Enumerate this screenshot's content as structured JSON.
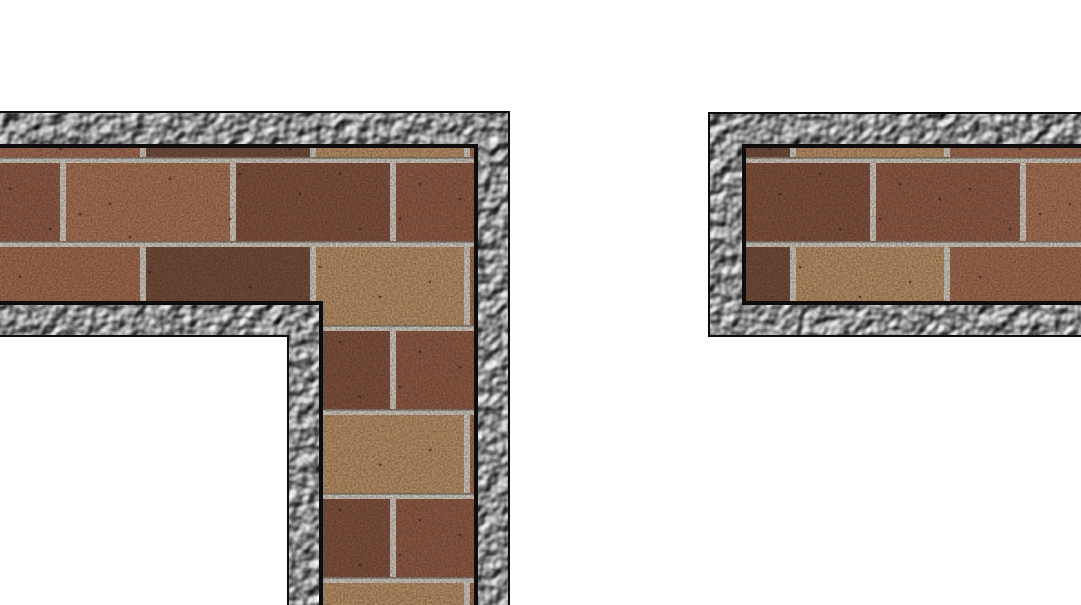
{
  "scene": {
    "description": "Top-down game map view: two brick wall segments with gravel stone borders on a white floor",
    "width": 1081,
    "height": 605,
    "background_color": "#ffffff"
  },
  "colors": {
    "outline": "#0c0c0c",
    "gravel_base": "#8f8f8f",
    "gravel_highlight": "#f0f0f0",
    "gravel_shadow": "#2f2f2f",
    "mortar": "#c9c4ba",
    "mortar_shadow": "#6b6258",
    "speckle": "#32211a",
    "brick_palette": [
      "#9a674c",
      "#6f4a39",
      "#b28b63",
      "#8a5843",
      "#a06e50",
      "#7c4f3b"
    ]
  },
  "walls": [
    {
      "name": "l-shaped-wall-segment",
      "outer": [
        [
          -6,
          111
        ],
        [
          510,
          111
        ],
        [
          510,
          611
        ],
        [
          287,
          611
        ],
        [
          287,
          337
        ],
        [
          -6,
          337
        ]
      ],
      "gravel": [
        [
          -6,
          113
        ],
        [
          508,
          113
        ],
        [
          508,
          611
        ],
        [
          289,
          611
        ],
        [
          289,
          335
        ],
        [
          -6,
          335
        ]
      ],
      "brick": [
        [
          -6,
          146
        ],
        [
          476,
          146
        ],
        [
          476,
          611
        ],
        [
          321,
          611
        ],
        [
          321,
          303
        ],
        [
          -6,
          303
        ]
      ]
    },
    {
      "name": "horizontal-wall-segment",
      "outer": [
        [
          708,
          112
        ],
        [
          1087,
          112
        ],
        [
          1087,
          337
        ],
        [
          708,
          337
        ]
      ],
      "gravel": [
        [
          710,
          114
        ],
        [
          1087,
          114
        ],
        [
          1087,
          335
        ],
        [
          710,
          335
        ]
      ],
      "brick": [
        [
          744,
          146
        ],
        [
          1087,
          146
        ],
        [
          1087,
          303
        ],
        [
          744,
          303
        ]
      ]
    }
  ],
  "brick_pattern": {
    "origin_x": -10,
    "origin_y": 79,
    "tile_width": 480,
    "tile_height": 168,
    "rows": [
      {
        "y": 0,
        "h": 78,
        "bricks": [
          {
            "x": 0,
            "w": 150,
            "c": 0
          },
          {
            "x": 156,
            "w": 164,
            "c": 1
          },
          {
            "x": 326,
            "w": 148,
            "c": 2
          }
        ]
      },
      {
        "y": 84,
        "h": 78,
        "bricks": [
          {
            "x": 0,
            "w": 70,
            "c": 3
          },
          {
            "x": 76,
            "w": 164,
            "c": 4
          },
          {
            "x": 246,
            "w": 154,
            "c": 5
          },
          {
            "x": 406,
            "w": 74,
            "c": 3
          }
        ]
      }
    ],
    "shadow_lines_y": [
      78,
      162
    ],
    "speckles": [
      [
        30,
        30
      ],
      [
        95,
        55
      ],
      [
        160,
        25
      ],
      [
        210,
        60
      ],
      [
        260,
        40
      ],
      [
        330,
        20
      ],
      [
        390,
        50
      ],
      [
        440,
        35
      ],
      [
        70,
        70
      ],
      [
        300,
        70
      ],
      [
        20,
        110
      ],
      [
        120,
        125
      ],
      [
        180,
        100
      ],
      [
        240,
        140
      ],
      [
        310,
        115
      ],
      [
        370,
        150
      ],
      [
        430,
        105
      ],
      [
        60,
        150
      ],
      [
        140,
        158
      ],
      [
        410,
        140
      ],
      [
        470,
        120
      ],
      [
        250,
        95
      ],
      [
        350,
        95
      ],
      [
        90,
        135
      ]
    ]
  }
}
